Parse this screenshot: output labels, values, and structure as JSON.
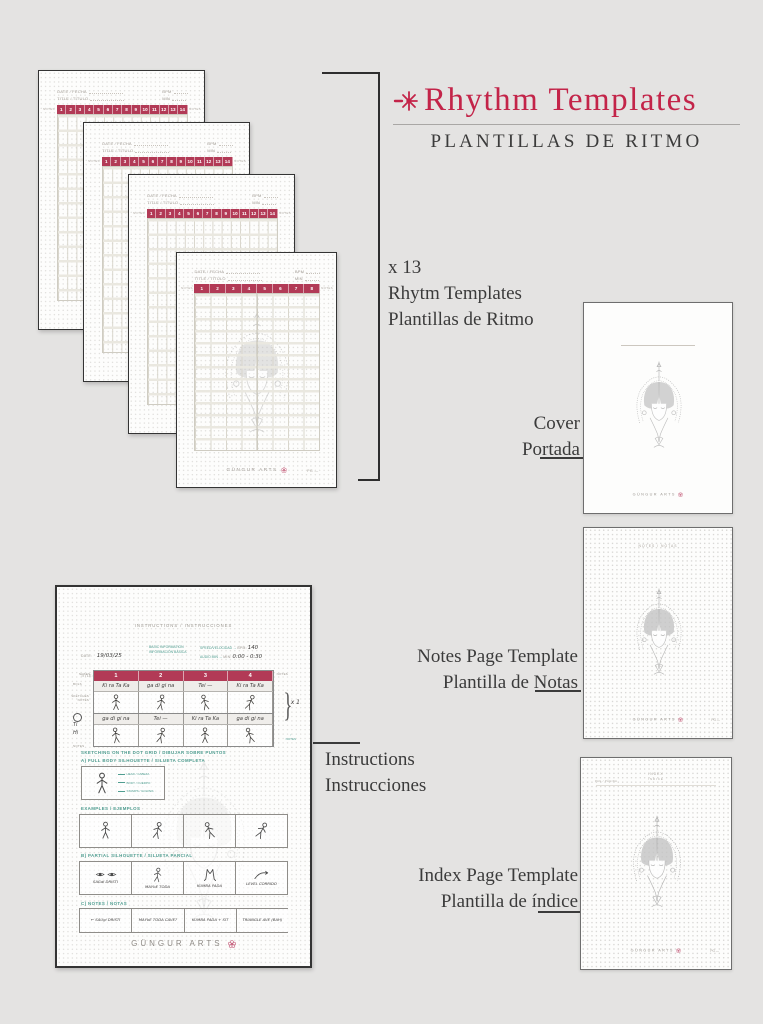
{
  "colors": {
    "accent": "#c32449",
    "beat_bar": "#b23a56",
    "teal": "#4f9d90",
    "text": "#3b3b3b",
    "background": "#e4e3e2"
  },
  "header": {
    "icon": "starburst-flower",
    "title": "Rhythm Templates",
    "subtitle": "PLANTILLAS DE RITMO"
  },
  "stack_caption": {
    "count": "x 13",
    "line_en": "Rhytm Templates",
    "line_es": "Plantillas de Ritmo"
  },
  "rhythm_page": {
    "date_label": "DATE / FECHA",
    "title_label": "TITLE / TÍTULO",
    "bpm_label": "BPM",
    "min_label": "MIN",
    "notes_label": "NOTES",
    "beats_back": [
      "1",
      "2",
      "3",
      "4",
      "5",
      "6",
      "7",
      "8",
      "9",
      "10",
      "11",
      "12",
      "13",
      "14"
    ],
    "beats_front": [
      "1",
      "2",
      "3",
      "4",
      "5",
      "6",
      "7",
      "8"
    ],
    "brand": "GÜNGUR ARTS",
    "page_label": "PG"
  },
  "cover": {
    "caption_en": "Cover",
    "caption_es": "Portada",
    "brand": "GÜNGUR ARTS"
  },
  "notes_template": {
    "caption_en": "Notes Page Template",
    "caption_es": "Plantilla de Notas",
    "heading": "NOTES / NOTAS",
    "brand": "GÜNGUR ARTS",
    "page_label": "PG"
  },
  "index_template": {
    "caption_en": "Index Page Template",
    "caption_es": "Plantilla de índice",
    "heading_en": "INDEX",
    "heading_es": "ÍNDICE",
    "corner_label": "PAG / PÁGINA",
    "brand": "GÜNGUR ARTS",
    "page_label": "PG"
  },
  "instructions": {
    "caption_en": "Instructions",
    "caption_es": "Instrucciones",
    "title": "INSTRUCTIONS / INSTRUCCIONES",
    "info": {
      "date_label": "DATE:",
      "date_value": "19/03/25",
      "title_label": "TITLE:",
      "title_value": "85mm",
      "basic_1": "BASIC INFORMATION",
      "basic_2": "INFORMACIÓN BÁSICA",
      "speed_label": "SPEED/VELOCIDAD",
      "speed_arrow": "→",
      "bpm_label": "BPM:",
      "bpm_value": "140",
      "audio_label": "AUDIO MIN",
      "audio_arrow": "→",
      "min_label": "MIN:",
      "min_value": "0:00 - 0:30"
    },
    "table": {
      "beats": [
        "1",
        "2",
        "3",
        "4"
      ],
      "row1_bols": [
        "Ki ra Ta Ka",
        "ga di gi na",
        "Tei  —",
        "Ki ra Ta Ka"
      ],
      "row2_bols": [
        "ga di gi na",
        "Tei  —",
        "Ki ra Ta Ka",
        "ga di gi na"
      ],
      "left_labels": {
        "notes_top": "NOTES",
        "bols": "BOLS",
        "sketches_1": "SKETCHES",
        "sketches_2": "NOTES",
        "hand_1": "Ti",
        "hand_2": "Hi",
        "notes_bottom": "NOTES"
      },
      "right_labels": {
        "notes_top": "NOTES",
        "repeat": "x 1",
        "arrow": "↑",
        "notes_bottom": "NOTES"
      }
    },
    "sections": {
      "sketching_title": "SKETCHING ON THE DOT GRID / DIBUJAR SOBRE PUNTOS",
      "a_title": "A) FULL BODY SILHOUETTE / SILUETA COMPLETA",
      "legend": [
        "HEAD / CABEZA",
        "BODY / CUERPO",
        "STAMPS / GOLPES"
      ],
      "examples_title": "EXAMPLES / EJEMPLOS",
      "b_title": "B) PARTIAL SILHOUETTE / SILUETA PARCIAL",
      "b_captions": [
        "SAGdi DRISTI",
        "MAYbE TODA",
        "KUMBA PADA",
        "LEVEL CORRIDO"
      ],
      "c_title": "C) NOTES / NOTAS",
      "c_notes": [
        "← SAUgi DRISTI",
        "MAYbE TODA CAVE?",
        "KUMBA PADA + SIT",
        "TRIANGLE AVE (BAH)"
      ]
    },
    "brand": "GÜNGUR ARTS"
  }
}
